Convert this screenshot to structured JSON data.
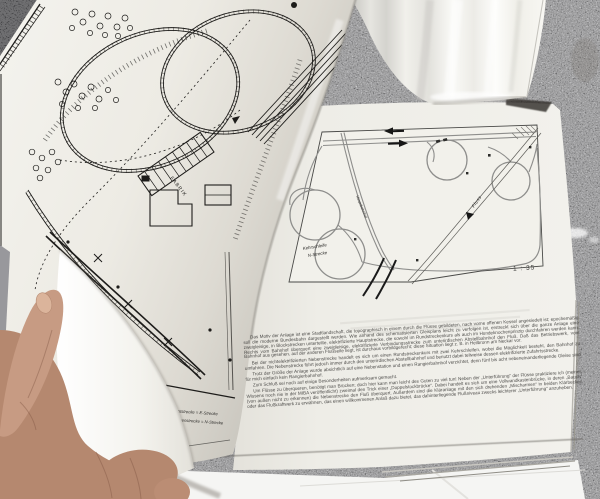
{
  "colors": {
    "granite_base": "#a4a4a8",
    "granite_dark_corner": "#232326",
    "paper_page": "#f0efe9",
    "paper_glossy": "#fafaf7",
    "plan_ink": "#1d1c1a",
    "diagram_track_grey": "#8e8e8c",
    "skin": "#b5886f",
    "under_sheet": "#f5f5f3"
  },
  "magazine": {
    "right_page": {
      "page_number": "55",
      "diagram": {
        "scale_label": "1 : 35",
        "kehrschleife_line1": "Kehrschleife",
        "kehrschleife_line2": "N-Strecke",
        "fluss_label": "Fluss",
        "hauptbahnhof_label": "Hauptbahnhof"
      },
      "body_paragraphs": [
        "Das Motiv der Anlage ist eine Stadtlandschaft, die topographisch in einem durch die Flüsse gebildeten, nach vorne offenen Kessel angesiedelt ist; epochemäßig soll die moderne Bundesbahn dargestellt werden. Wie anhand des schematisierten Gleisplans leicht zu verfolgen ist, erstreckt sich über die ganze Anlage eine zweigleisige, in Blockstrecken unterteilte, elektrifizierte Hauptstrecke, die sowohl im Rundstreckenkurs als auch im Hundeknochenprinzip durchfahren werden kann. Rechts vom Bahnhof überquert eine zweigleisige, elektrifizierte Verbindungsstrecke zum unterirdischen Abstellbahnhof den Fluß. Daß das Betriebswerk, vom Bahnhof aus gesehen, auf der anderen Flußseite liegt, ist durchaus vorbildgerecht; diese Situation liegt z. B. in Heilbronn am Neckar vor.",
        "Bei der nichtelektrifizierten Nebenstrecke handelt es sich um einen Rundstreckenkurs mit zwei Kehrschleifen, wobei die Möglichkeit besteht, den Bahnhof zu umfahren. Die Nebenstrecke führt jedoch immer durch den unterirdischen Abstellbahnhof und benutzt dabei teilweise dessen elektrifizierte Zufahrtsstrecke.",
        "Trotz der Größe der Anlage wurde absichtlich auf eine Nebenstation und einen Rangierbahnhof verzichtet, denn fünf bis acht nebeneinanderliegende Gleise sind für mich einfach kein Rangierbahnhof.",
        "Zum Schluß sei noch auf einige Besonderheiten aufmerksam gemacht.",
        "Um Flüsse zu überqueren, benötigt man Brücken; doch hier kann man leicht des Guten zu viel tun! Neben der „Unterführung“ der Flüsse praktiziere ich (meines Wissens noch nie in der MIBA veröffentlicht) zweimal den Trick einer „Doppelstockbrücke“. Dabei handelt es sich um eine Vollwandkastenbrücke, in deren „Bauch“ (von außen nicht zu erkennen) die Nebenstrecke den Fluß überquert. Außerdem sind die Kläranlage mit den sich drehenden „Mischarmen“ in beiden Klärbecken oder das Flußkraftwerk zu erwähnen, das einen willkommenen Anlaß dazu bietet, das dahinterliegende Flußniveau zwecks leichterer „Unterführung“ anzuheben."
      ]
    },
    "left_page": {
      "fabrik_label": "FABRIK",
      "legend_line1": "Hauptstrecke = E-Strecke",
      "legend_line2": "Nebenstrecke = N-Strecke"
    }
  }
}
